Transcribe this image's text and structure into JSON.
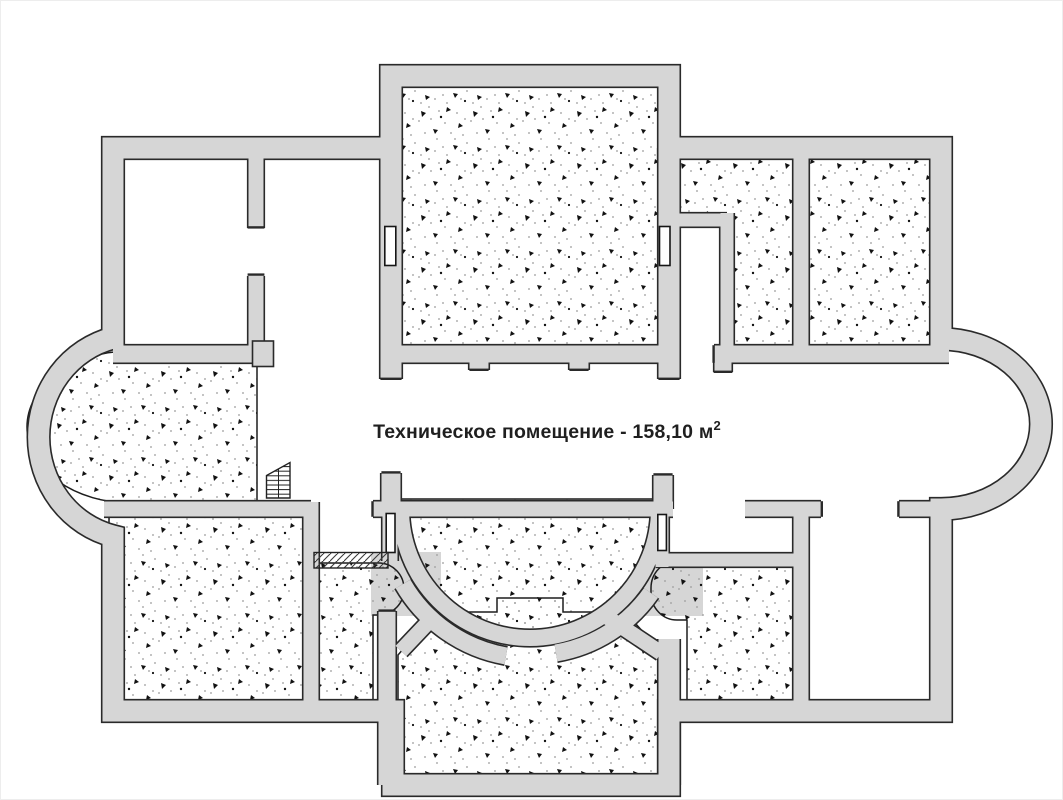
{
  "floor_plan": {
    "room_label": {
      "room_name": "Техническое помещение",
      "area_value": "158,10",
      "area_unit": "м",
      "area_superscript": "2",
      "full_text": "Техническое помещение - 158,10 м"
    },
    "colors": {
      "background": "#ffffff",
      "wall_fill": "#d6d6d6",
      "wall_outline": "#2a2a2a",
      "speckle_mark": "#111111",
      "speckle_dot": "#9a9a9a"
    },
    "icons": [
      "stairs-icon",
      "vent-hatch-icon",
      "door-window-slot"
    ]
  }
}
